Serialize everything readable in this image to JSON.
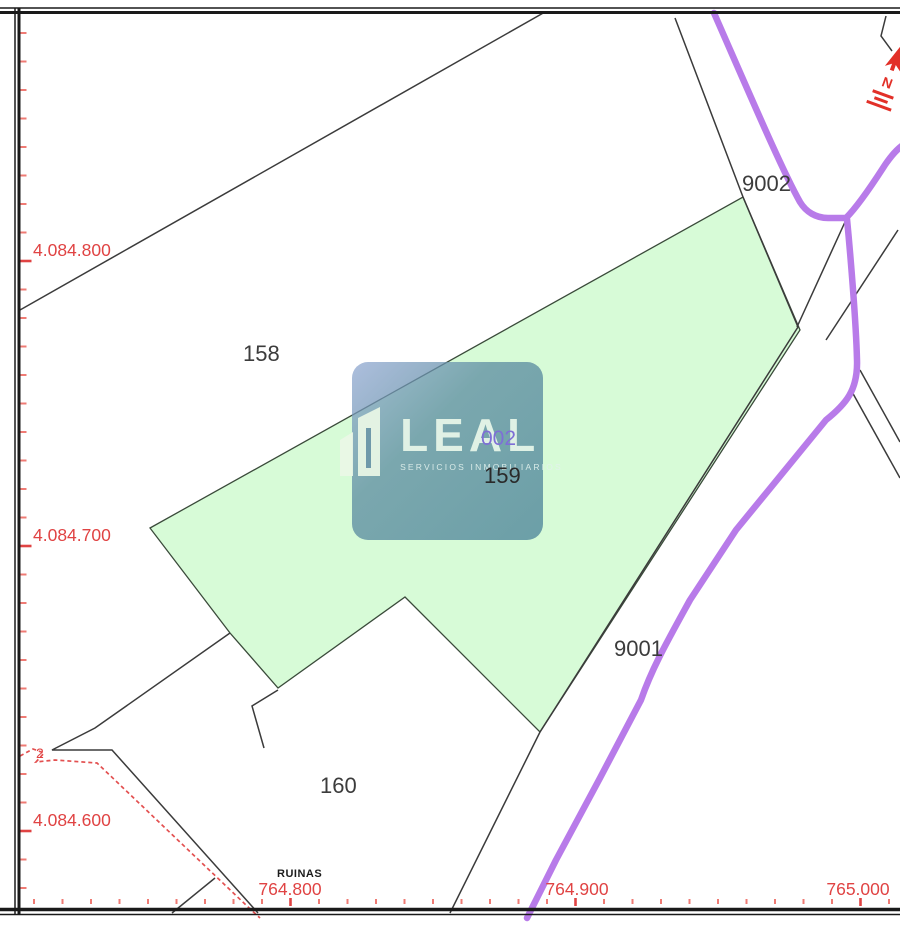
{
  "axis": {
    "y": [
      {
        "label": "4.084.800"
      },
      {
        "label": "4.084.700"
      },
      {
        "label": "4.084.600"
      }
    ],
    "x": [
      {
        "label": "764.800"
      },
      {
        "label": "764.900"
      },
      {
        "label": "765.000"
      }
    ]
  },
  "parcels": [
    {
      "id": "158"
    },
    {
      "id": "159"
    },
    {
      "id": "160"
    },
    {
      "id": "9001"
    },
    {
      "id": "9002"
    },
    {
      "id": "002"
    },
    {
      "id": "2"
    }
  ],
  "annotations": {
    "ruins": "RUINAS"
  },
  "watermark": {
    "brand": "LEAL",
    "tagline": "SERVICIOS INMOBILIARIOS"
  },
  "compass": {
    "letter": "N"
  },
  "colors": {
    "parcel_highlight": "#d7fbd7",
    "parcel_edge": "#3a4a3a",
    "road": "#b87be9",
    "boundary_line": "#3b3b3b",
    "axis_red": "#e04343",
    "axis_tick": "#ef7b74",
    "label_gray": "#3c3c3c",
    "overlay_code_purple": "#7e6fd6",
    "compass_red": "#e23028"
  }
}
